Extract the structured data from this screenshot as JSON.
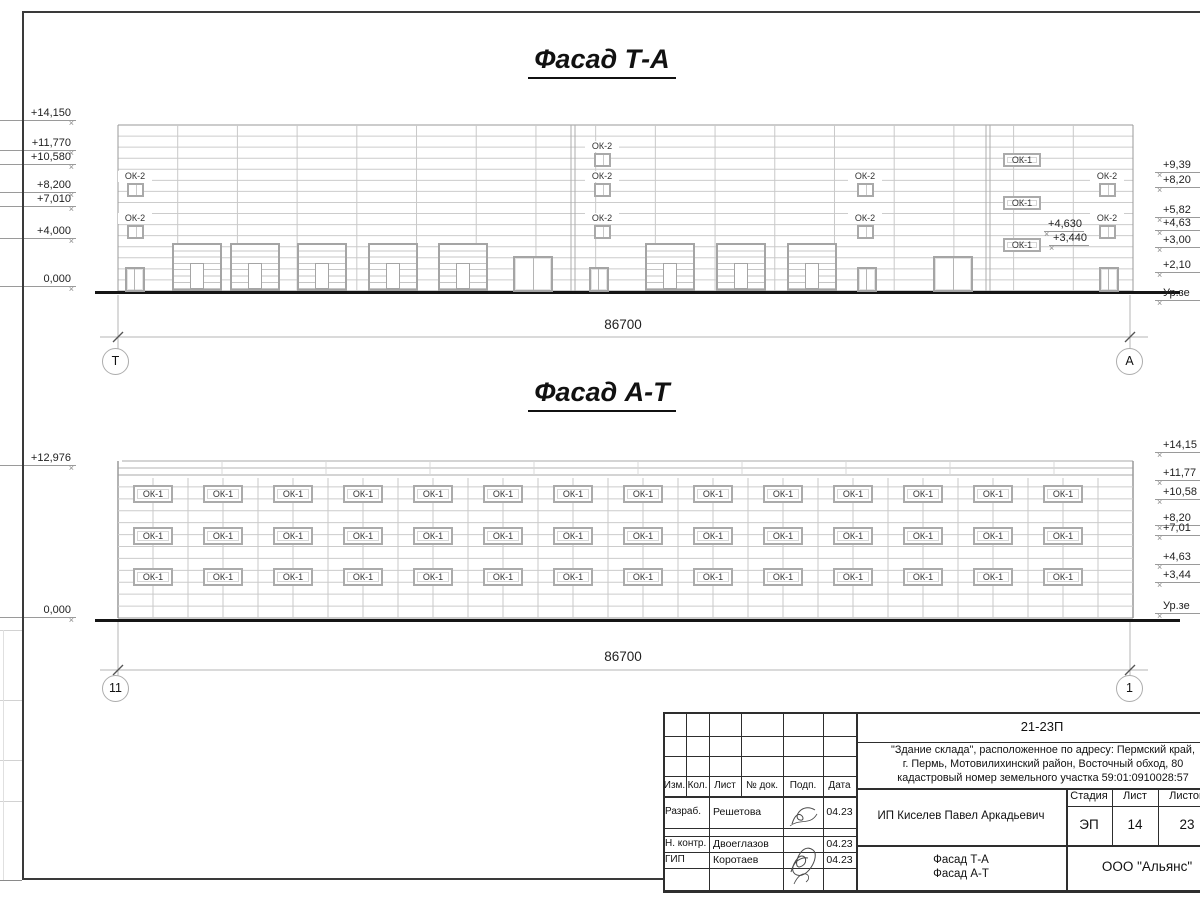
{
  "titles": {
    "facade_ta": "Фасад Т-А",
    "facade_at": "Фасад А-Т"
  },
  "facade_ta": {
    "dimension": "86700",
    "axis_left": "Т",
    "axis_right": "А",
    "left_marks": [
      "+14,150",
      "+11,770",
      "+10,580",
      "+8,200",
      "+7,010",
      "+4,000",
      "0,000"
    ],
    "right_marks": [
      "+9,39",
      "+8,20",
      "+5,82",
      "+4,63",
      "+3,00",
      "+2,10",
      "Ур.зе"
    ],
    "inline_marks": [
      "+4,630",
      "+3,440"
    ],
    "window_label_small": "ОК-2",
    "window_label_ribbon": "ОК-1"
  },
  "facade_at": {
    "dimension": "86700",
    "axis_left": "11",
    "axis_right": "1",
    "left_marks": [
      "+12,976",
      "0,000"
    ],
    "right_marks": [
      "+14,15",
      "+11,77",
      "+10,58",
      "+8,20",
      "+7,01",
      "+4,63",
      "+3,44",
      "Ур.зе"
    ],
    "window_label": "ОК-1",
    "window_rows": 3,
    "window_cols": 14
  },
  "stamp": {
    "doc_number": "21-23П",
    "description": "\"Здание склада\", расположенное по адресу: Пермский край,\nг. Пермь, Мотовилихинский район, Восточный обход, 80\nкадастровый номер земельного участка 59:01:0910028:57",
    "client": "ИП Киселев Павел Аркадьевич",
    "sheet_name": "Фасад Т-А\nФасад А-Т",
    "company": "ООО \"Альянс\"",
    "stage_label": "Стадия",
    "stage": "ЭП",
    "sheet_label": "Лист",
    "sheet_number": "14",
    "sheets_label": "Листов",
    "sheets_total": "23",
    "columns": [
      "Изм.",
      "Кол.",
      "Лист",
      "№ док.",
      "Подп.",
      "Дата"
    ],
    "roles": [
      {
        "role": "Разраб.",
        "name": "Решетова",
        "date": "04.23"
      },
      {
        "role": "Н. контр.",
        "name": "Двоеглазов",
        "date": "04.23"
      },
      {
        "role": "ГИП",
        "name": "Коротаев",
        "date": "04.23"
      }
    ]
  }
}
